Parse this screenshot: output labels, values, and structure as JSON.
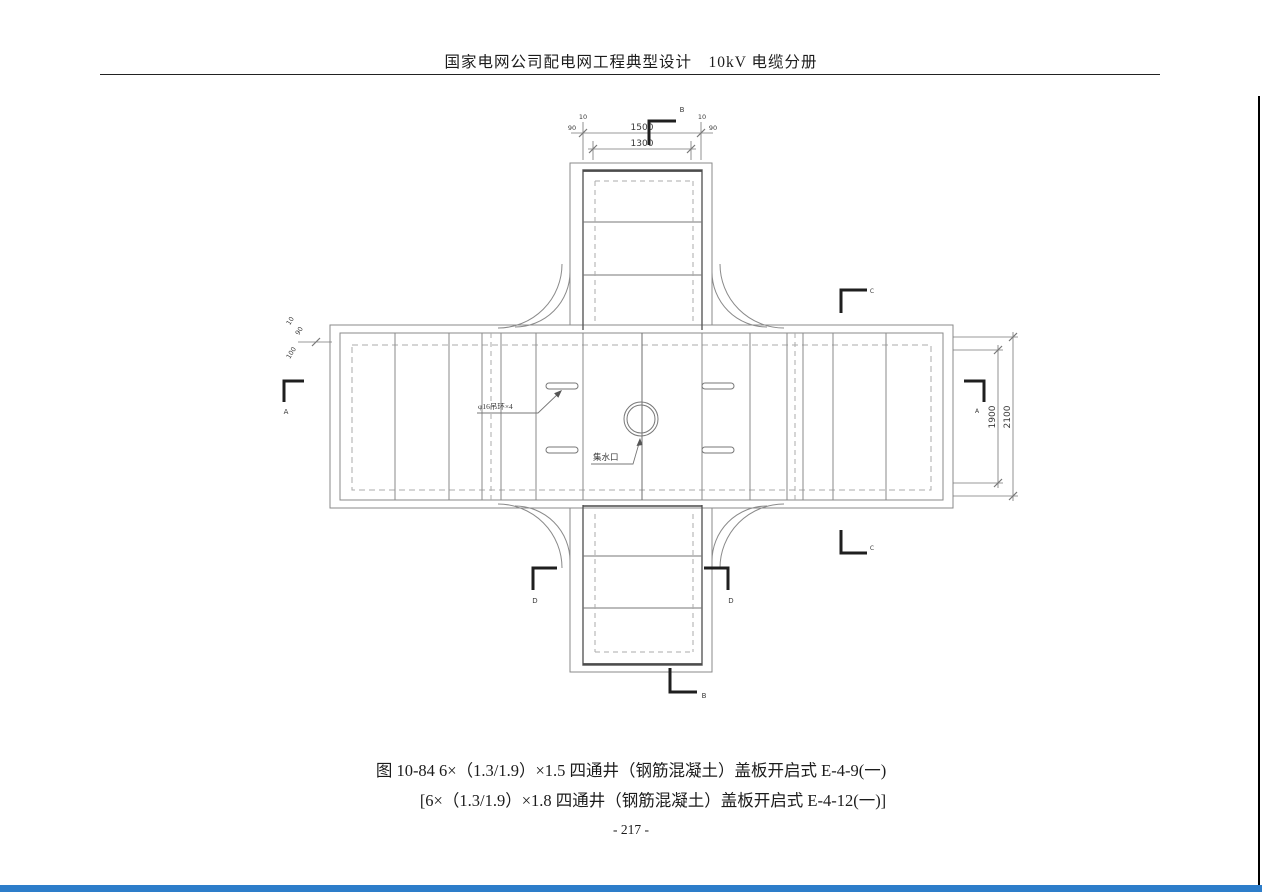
{
  "header": {
    "title": "国家电网公司配电网工程典型设计　10kV 电缆分册"
  },
  "figure": {
    "caption_line1": "图 10-84 6×（1.3/1.9）×1.5 四通井（钢筋混凝土）盖板开启式 E-4-9(一)",
    "caption_line2": "[6×（1.3/1.9）×1.8 四通井（钢筋混凝土）盖板开启式 E-4-12(一)]"
  },
  "footer": {
    "page_number": "- 217 -"
  },
  "drawing": {
    "annotations": {
      "lifting_rings": "φ16吊环×4",
      "water_inlet": "集水口"
    },
    "dims": {
      "d1500": "1500",
      "d1300": "1300",
      "d1900": "1900",
      "d2100": "2100",
      "d10": "10",
      "d90": "90",
      "d100": "100"
    },
    "sections": {
      "a": "A",
      "b": "B",
      "c": "C",
      "d": "D"
    }
  },
  "colors": {
    "accent_bar": "#2d7dca",
    "drawing_line": "#7a7a7a",
    "dark_line": "#1f1f1f"
  }
}
